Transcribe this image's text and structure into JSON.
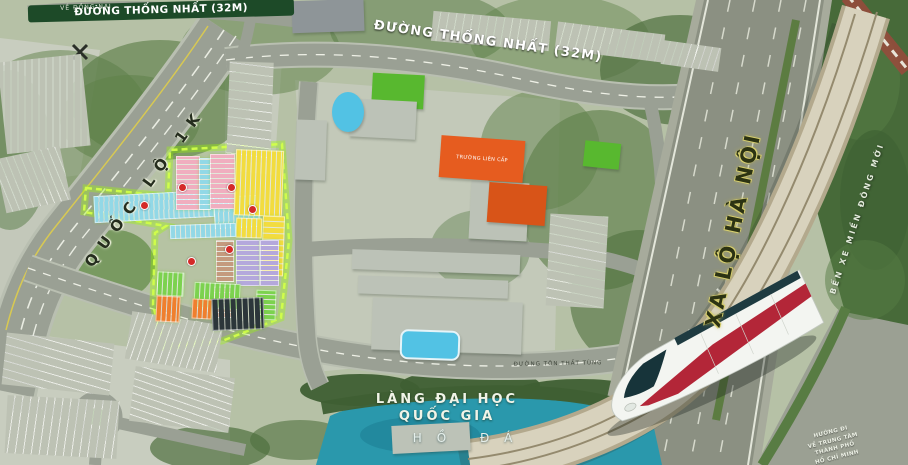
{
  "labels": {
    "road_top": "ĐƯỜNG THỐNG NHẤT (32M)",
    "road_mid": "ĐƯỜNG THỐNG NHẤT (32M)",
    "road_left_vertical": "QUỐC LỘ 1K",
    "highway_vertical": "XA LỘ HÀ NỘI",
    "road_bottom": "ĐƯỜNG TÔN THẤT TÙNG",
    "top_left_small": "VỀ ĐỒNG NAI",
    "right_edge_vertical": "BẾN XE MIỀN ĐÔNG MỚI",
    "university_line1": "LÀNG ĐẠI HỌC",
    "university_line2": "QUỐC GIA",
    "lake": "HỒ ĐÁ",
    "school": "TRƯỜNG LIÊN CẤP",
    "direction_lines": [
      "HƯỚNG ĐI",
      "VỀ TRUNG TÂM",
      "THÀNH PHỐ",
      "HỒ CHÍ MINH"
    ]
  },
  "colors": {
    "map_base": "#b6c1a6",
    "road": "#9aa094",
    "highway": "#8b9082",
    "guideway": "#d6cfb8",
    "tree_dark": "#4e6f3e",
    "lake": "#2a98ac",
    "boundary_glow": "#a6ff2e",
    "label_badge_bg": "#1d4a28",
    "lot_cyan": "#92d8e6",
    "lot_pink": "#f0aebf",
    "lot_yellow": "#f2dc3f",
    "lot_tan": "#c49a7e",
    "lot_purple": "#b4a8dc",
    "lot_green": "#7cd24f",
    "lot_orange": "#ef7f2e",
    "parking_dark": "#2c363a",
    "parking_base": "#bdc2b4",
    "building_gray": "#bcc2b7",
    "building_dark": "#8e9598",
    "school_orange": "#e65c1f",
    "school_orange2": "#d85418",
    "field_green": "#58b82f",
    "pool_blue": "#52c2e4",
    "train_red": "#b32638",
    "badge_red": "#d42a28"
  }
}
